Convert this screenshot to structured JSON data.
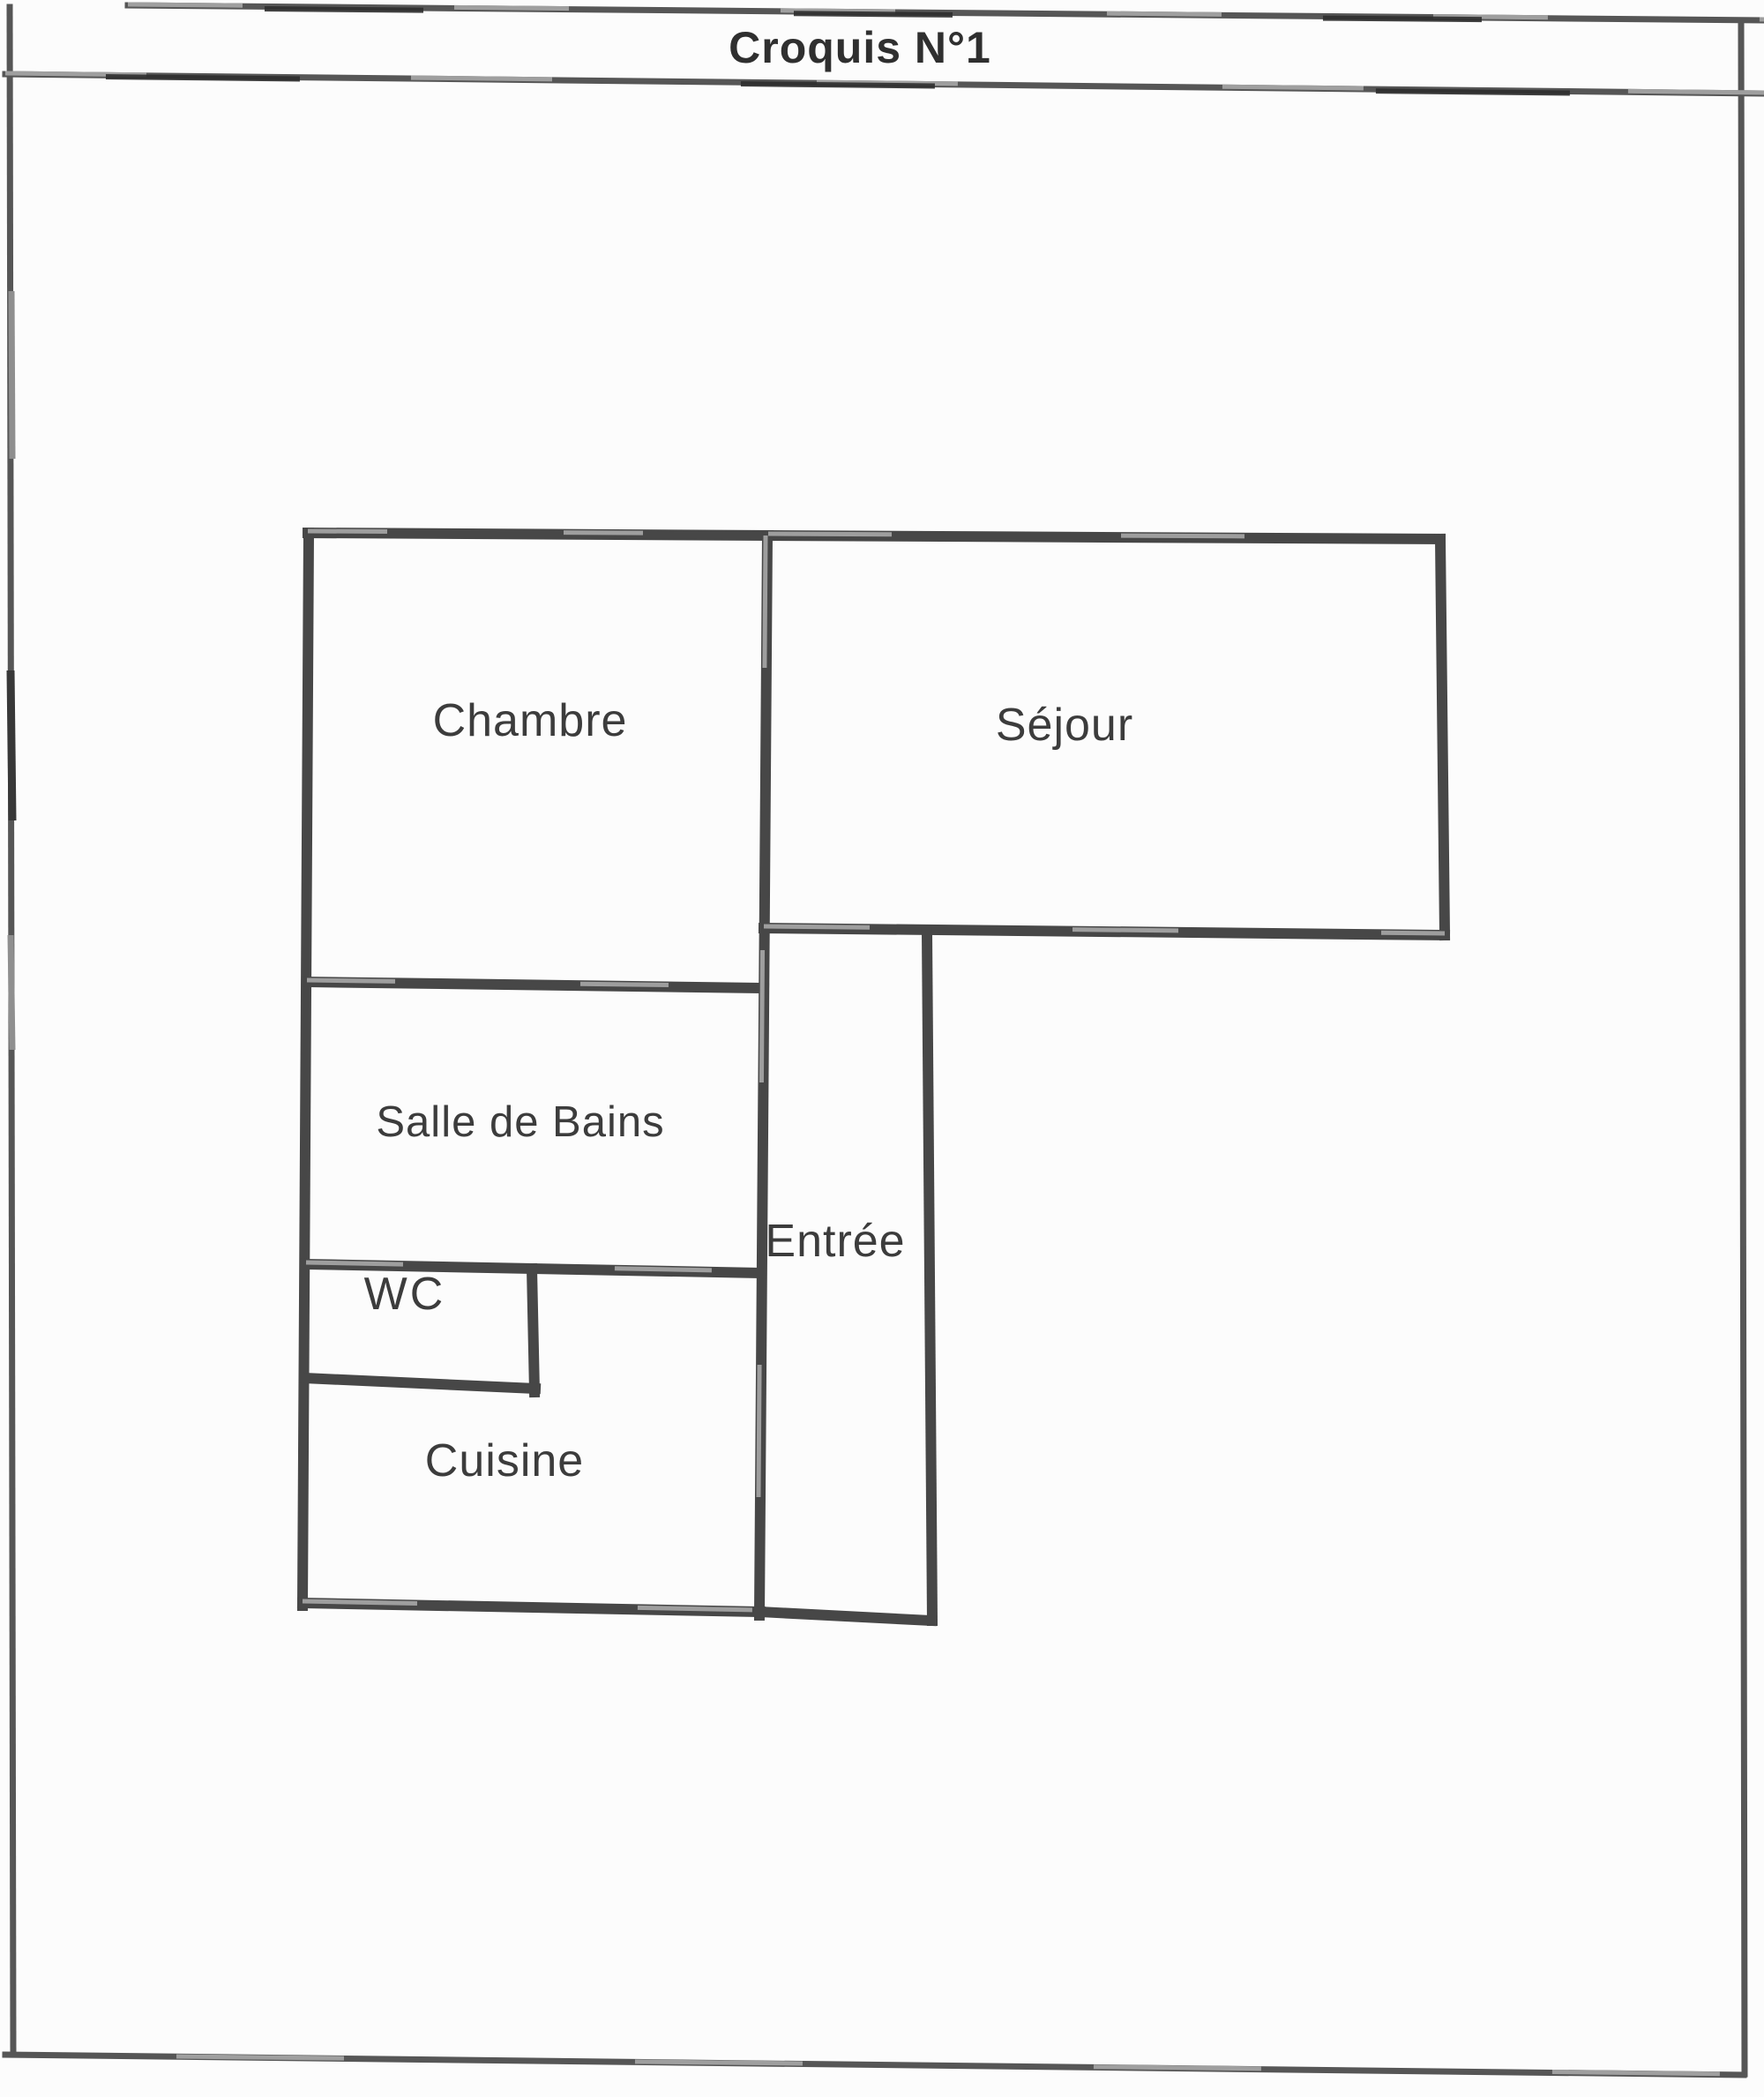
{
  "header": {
    "title": "Croquis N°1"
  },
  "floor_plan": {
    "rooms": [
      {
        "id": "chambre",
        "label": "Chambre"
      },
      {
        "id": "sejour",
        "label": "Séjour"
      },
      {
        "id": "salle_de_bains",
        "label": "Salle de Bains"
      },
      {
        "id": "wc",
        "label": "WC"
      },
      {
        "id": "entree",
        "label": "Entrée"
      },
      {
        "id": "cuisine",
        "label": "Cuisine"
      }
    ]
  },
  "colors": {
    "paper": "#fcfcfc",
    "wall": "#474747",
    "border": "#565656",
    "ink": "#3c3c3c"
  }
}
